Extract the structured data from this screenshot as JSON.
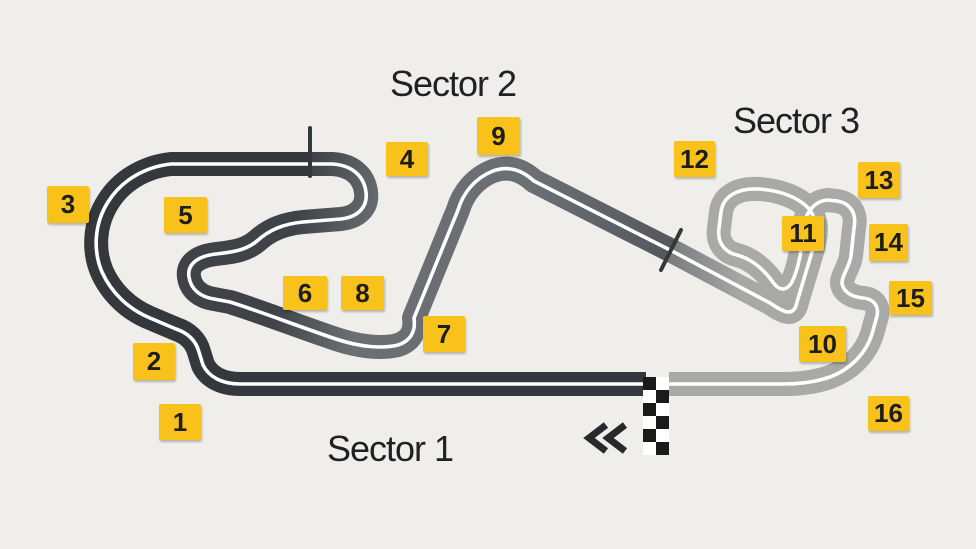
{
  "colors": {
    "background": "#efeeea",
    "sector1": "#34373b",
    "sector2_start": "#3f4246",
    "sector2_mid": "#6b6e72",
    "sector2_end": "#54575b",
    "sector3_start": "#7b7d80",
    "sector3_light": "#a7a7a6",
    "sector3_main": "#a9a9a7",
    "centerline": "#ffffff",
    "tick": "#34373b",
    "flag_dark": "#1a1a1a",
    "flag_light": "#ffffff",
    "arrow": "#27292b",
    "badge_bg": "#f9c21b",
    "badge_text": "#1d1d1b",
    "label_text": "#202124"
  },
  "sectors": [
    {
      "label": "Sector 1",
      "x": 327,
      "y": 428
    },
    {
      "label": "Sector 2",
      "x": 390,
      "y": 63
    },
    {
      "label": "Sector 3",
      "x": 733,
      "y": 100
    }
  ],
  "turns": [
    {
      "n": "1",
      "x": 159,
      "y": 404,
      "w": 42,
      "h": 36
    },
    {
      "n": "2",
      "x": 133,
      "y": 343,
      "w": 42,
      "h": 37
    },
    {
      "n": "3",
      "x": 47,
      "y": 186,
      "w": 42,
      "h": 37
    },
    {
      "n": "4",
      "x": 386,
      "y": 142,
      "w": 42,
      "h": 34
    },
    {
      "n": "5",
      "x": 164,
      "y": 197,
      "w": 43,
      "h": 36
    },
    {
      "n": "6",
      "x": 283,
      "y": 276,
      "w": 44,
      "h": 34
    },
    {
      "n": "7",
      "x": 423,
      "y": 316,
      "w": 42,
      "h": 36
    },
    {
      "n": "8",
      "x": 341,
      "y": 276,
      "w": 43,
      "h": 34
    },
    {
      "n": "9",
      "x": 477,
      "y": 117,
      "w": 43,
      "h": 38
    },
    {
      "n": "10",
      "x": 799,
      "y": 326,
      "w": 47,
      "h": 36
    },
    {
      "n": "11",
      "x": 782,
      "y": 216,
      "w": 42,
      "h": 35
    },
    {
      "n": "12",
      "x": 674,
      "y": 141,
      "w": 41,
      "h": 36
    },
    {
      "n": "13",
      "x": 858,
      "y": 162,
      "w": 42,
      "h": 36
    },
    {
      "n": "14",
      "x": 869,
      "y": 224,
      "w": 39,
      "h": 37
    },
    {
      "n": "15",
      "x": 889,
      "y": 281,
      "w": 43,
      "h": 34
    },
    {
      "n": "16",
      "x": 868,
      "y": 396,
      "w": 41,
      "h": 35
    }
  ],
  "finish_flag": {
    "x": 643,
    "y": 377,
    "cols": 2,
    "rows": 6,
    "cell": 13
  }
}
